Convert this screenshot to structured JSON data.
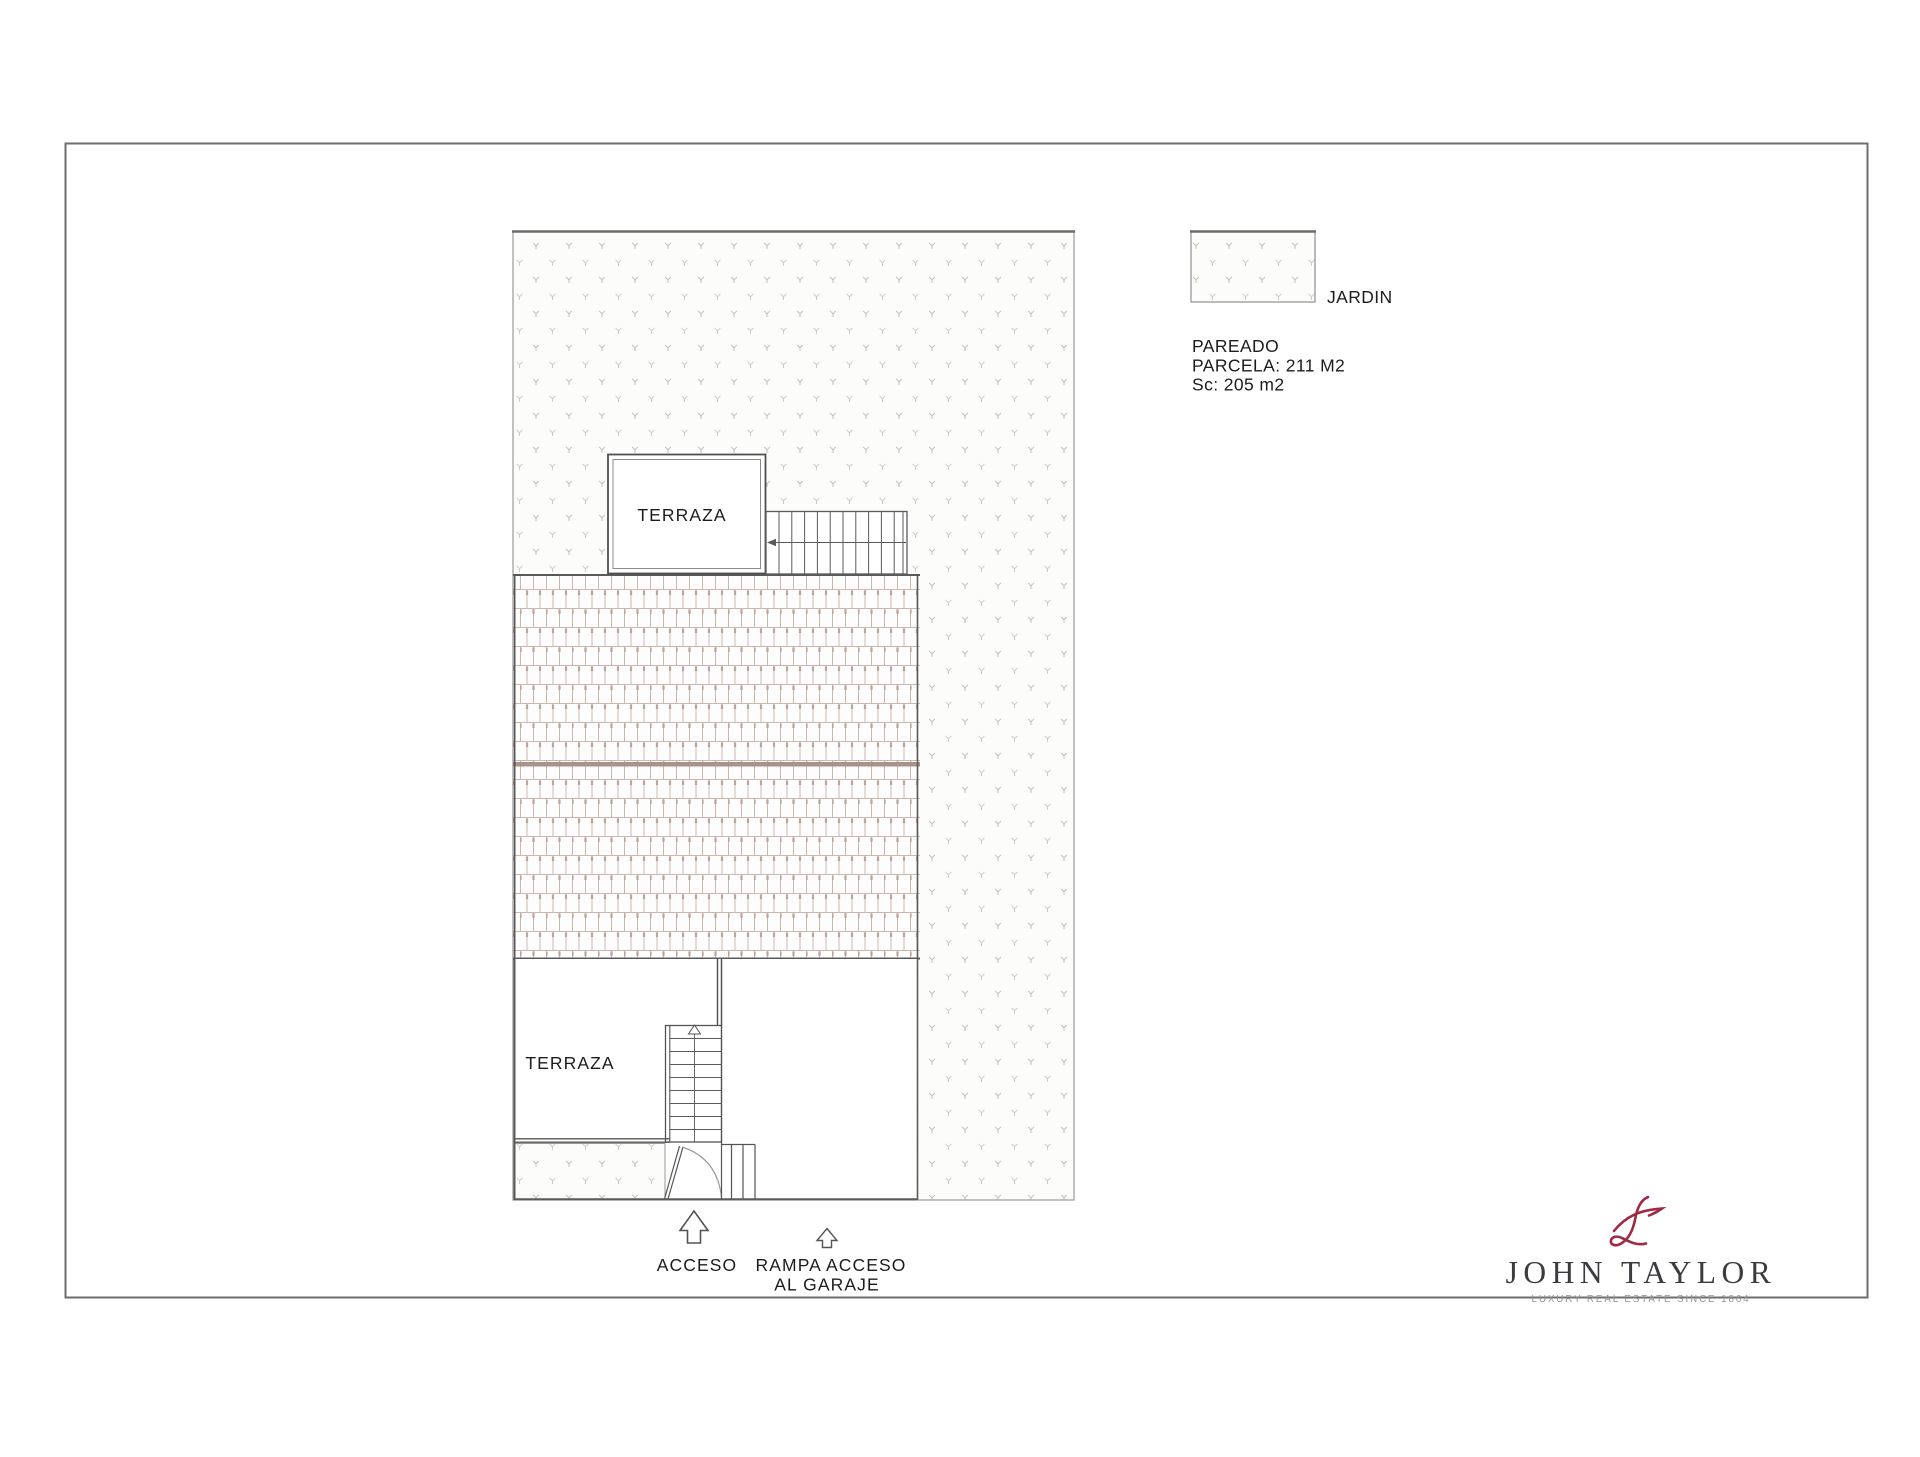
{
  "legend": {
    "jardin_label": "JARDIN"
  },
  "property_info": {
    "type": "PAREADO",
    "parcela": "PARCELA: 211 M2",
    "sc": "Sc: 205 m2"
  },
  "plan_labels": {
    "terrace_upper": "TERRAZA",
    "terrace_lower": "TERRAZA",
    "acceso": "ACCESO",
    "rampa_line1": "RAMPA ACCESO",
    "rampa_line2": "AL GARAJE"
  },
  "branding": {
    "name": "JOHN TAYLOR",
    "tagline": "LUXURY REAL ESTATE SINCE 1864",
    "monogram_icon": "jt-script-monogram",
    "accent_color": "#9e2a45",
    "name_color": "#3b3b40"
  },
  "drawing": {
    "garden_pattern": "dotted-grass-hatch",
    "roof_pattern": "staggered-roof-tiles",
    "wall_color": "#545454",
    "tile_line_color": "#cdb6ae"
  }
}
